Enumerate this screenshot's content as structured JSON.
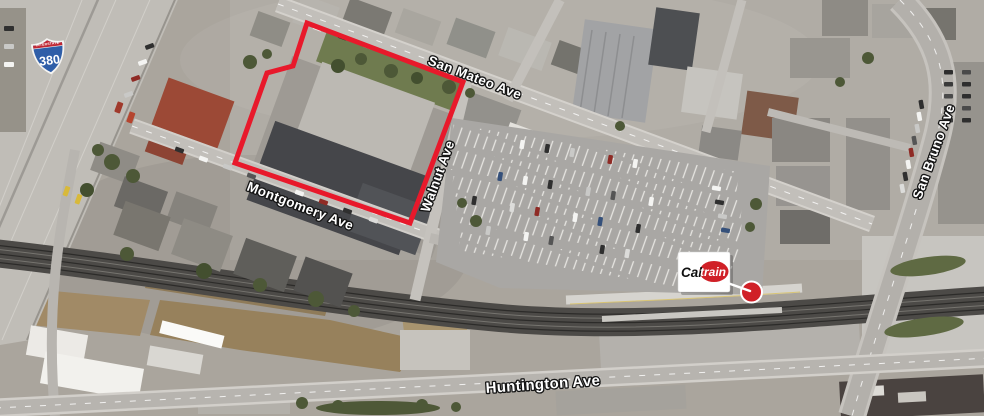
{
  "map": {
    "kind": "satellite aerial photo with site annotations"
  },
  "streets": {
    "san_mateo": "San Mateo Ave",
    "montgomery": "Montgomery Ave",
    "walnut": "Walnut Ave",
    "huntington": "Huntington Ave",
    "san_bruno": "San Bruno Ave"
  },
  "highway_shield": {
    "banner": "INTERSTATE",
    "route": "380"
  },
  "caltrain": {
    "wordmark_prefix": "Cal",
    "wordmark_suffix": "train"
  },
  "colors": {
    "property_outline": "#e8192b",
    "caltrain_red": "#d02027",
    "marker_red": "#d02027",
    "shield_red": "#c02733",
    "shield_blue": "#2f5ea8"
  }
}
